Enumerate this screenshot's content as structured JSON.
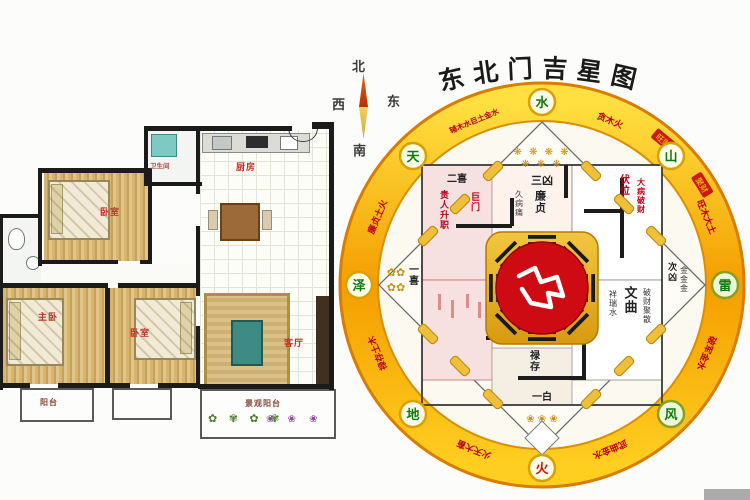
{
  "title": "东北门吉星图",
  "compass": {
    "north": "北",
    "west": "西",
    "east": "东",
    "south": "南"
  },
  "floor_plan": {
    "labels": {
      "bath_top": "卫生间",
      "kitchen": "厨房",
      "bedroom_top": "卧室",
      "master_bedroom": "主卧",
      "bedroom_bottom": "卧室",
      "living_room": "客厅",
      "balcony": "阳台",
      "landscape_balcony": "景观阳台"
    },
    "plants_row1": "✿ ✾ ✿ ✾",
    "plants_row2": "❀ ❀ ❀"
  },
  "chart": {
    "badges": [
      {
        "dir": "N",
        "label": "水"
      },
      {
        "dir": "NE",
        "label": "山"
      },
      {
        "dir": "E",
        "label": "雷"
      },
      {
        "dir": "SE",
        "label": "风"
      },
      {
        "dir": "S",
        "label": "火"
      },
      {
        "dir": "SW",
        "label": "地"
      },
      {
        "dir": "W",
        "label": "泽"
      },
      {
        "dir": "NW",
        "label": "天"
      }
    ],
    "ring_texts": [
      "贪木火",
      "旺木大土",
      "破军金水",
      "武曲金水",
      "火天大畜",
      "禄存土木",
      "廉贞土火",
      "辅木水巨土金水"
    ],
    "ring_stamps": [
      "旺财",
      "聚财"
    ],
    "inner": {
      "stars_row1": "❋ ❋ ❋ ❋",
      "stars_row2": "❋ ❋ ❋",
      "san_xiong": "三凶",
      "er_xi": "二喜",
      "gui_ren": "贵人升职",
      "ju_men": "巨门",
      "jiu_bing": "久病痛",
      "lian_zhen": "廉贞",
      "fu_wei": "伏位",
      "da_bing": "大病破财",
      "wen_qu": "文曲",
      "xiang_rui": "祥瑞水",
      "po_cai": "破财聚散",
      "ci_xiong": "次凶",
      "jin3": "金金金",
      "yi_xi": "一喜",
      "lu_cun": "禄存",
      "yi_bai": "一白",
      "rosettes_left_1": "✿✿",
      "rosettes_left_2": "✿✿",
      "rosettes_bottom": "❀ ❀ ❀"
    },
    "colors": {
      "ring_gold": "#f49e00",
      "ring_yellow": "#ffe040",
      "center_red": "#ce0b12",
      "accent_red": "#c00016"
    }
  }
}
